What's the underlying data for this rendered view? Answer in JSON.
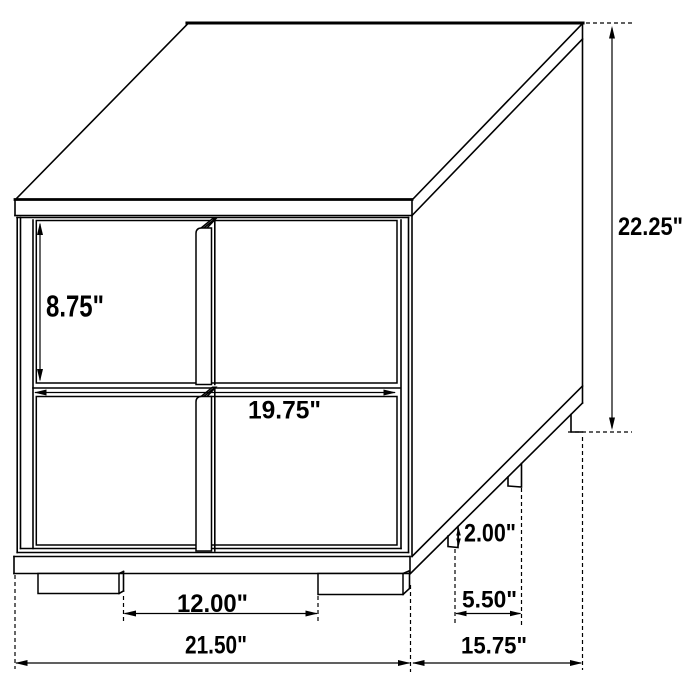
{
  "figure": {
    "subject": "two-drawer nightstand dimension drawing"
  },
  "dimensions": {
    "drawer_height": {
      "label": "8.75\""
    },
    "overall_height": {
      "label": "22.25\""
    },
    "drawer_width": {
      "label": "19.75\""
    },
    "front_leg_spacing": {
      "label": "12.00\""
    },
    "overall_width": {
      "label": "21.50\""
    },
    "leg_height": {
      "label": "2.00\""
    },
    "side_leg_spacing": {
      "label": "5.50\""
    },
    "overall_depth": {
      "label": "15.75\""
    }
  },
  "colors": {
    "line": "#000000",
    "background": "#ffffff"
  }
}
